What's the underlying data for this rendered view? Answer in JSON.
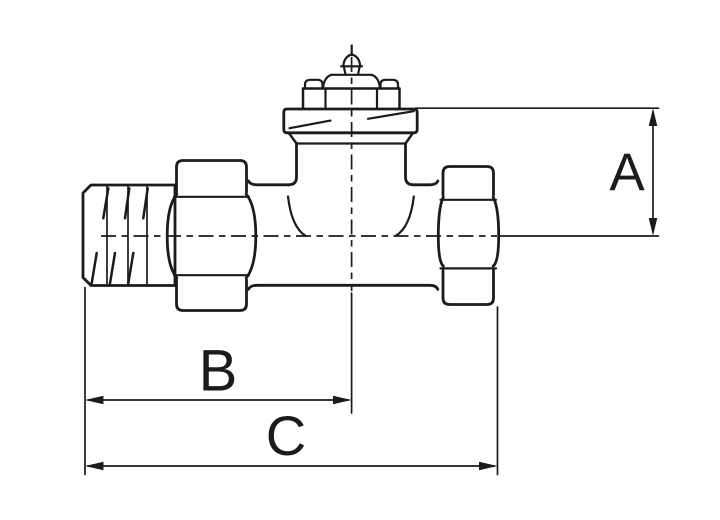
{
  "drawing": {
    "dimension_labels": {
      "a": "A",
      "b": "B",
      "c": "C"
    }
  },
  "colors": {
    "line": "#1b1b1b",
    "background": "#ffffff"
  }
}
